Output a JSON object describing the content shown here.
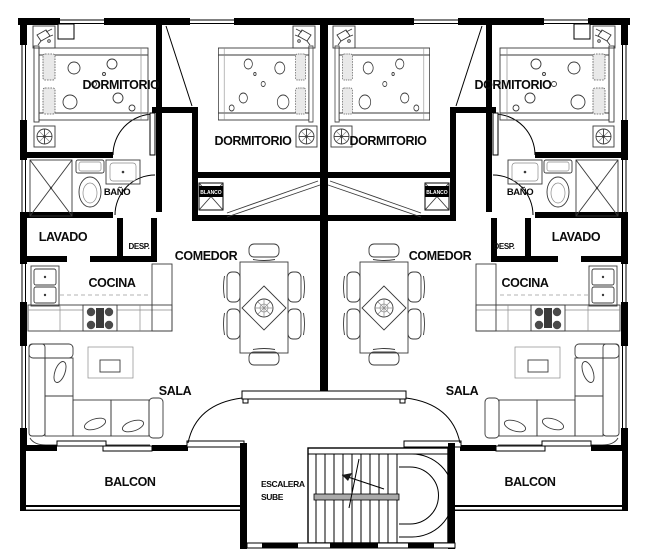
{
  "drawing_type": "apartment-floor-plan",
  "colors": {
    "wall": "#000000",
    "furniture_line": "#3a3a3a",
    "background": "#ffffff",
    "stair_rail": "#aaaaaa"
  },
  "units": {
    "left": {
      "bedroom_outer": "DORMITORIO",
      "bedroom_inner": "DORMITORIO",
      "bathroom": "BAÑO",
      "laundry": "LAVADO",
      "pantry": "DESP.",
      "dining": "COMEDOR",
      "kitchen": "COCINA",
      "living": "SALA",
      "balcony": "BALCON",
      "closet": "BLANCO"
    },
    "right": {
      "bedroom_outer": "DORMITORIO",
      "bedroom_inner": "DORMITORIO",
      "bathroom": "BAÑO",
      "laundry": "LAVADO",
      "pantry": "DESP.",
      "dining": "COMEDOR",
      "kitchen": "COCINA",
      "living": "SALA",
      "balcony": "BALCON",
      "closet": "BLANCO"
    }
  },
  "stairwell": {
    "name": "ESCALERA",
    "direction": "SUBE"
  }
}
